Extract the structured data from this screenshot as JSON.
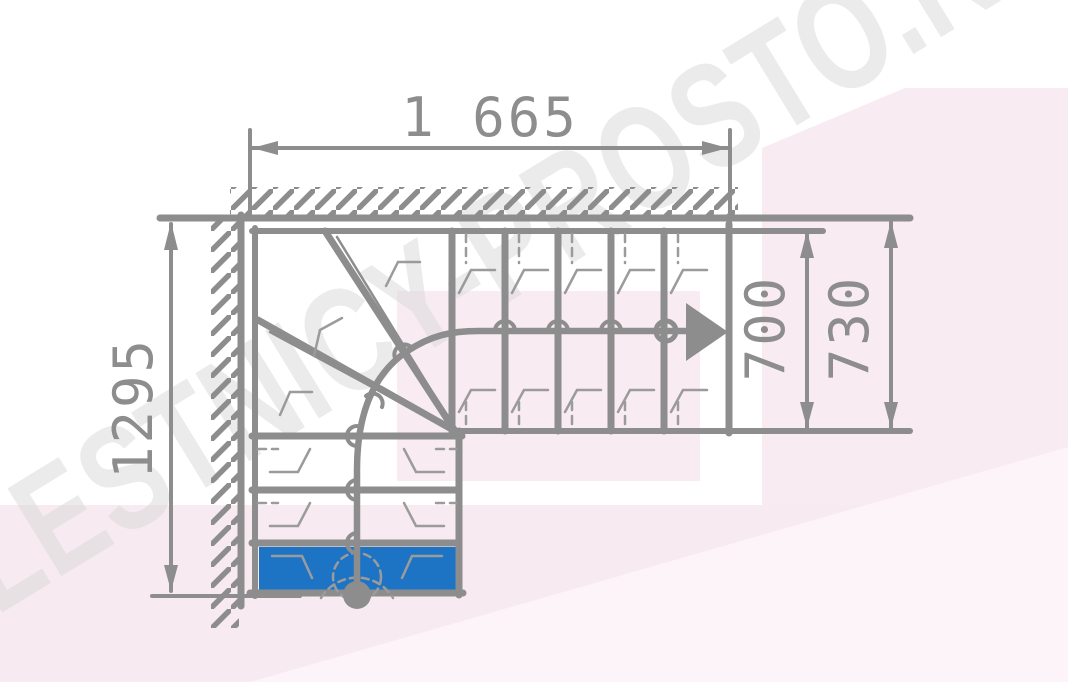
{
  "drawing": {
    "watermark": "LESTNICY-PROSTO.RU",
    "dimensions": {
      "top_width_label": "1 665",
      "left_height_label": "1295",
      "flight_width_inner_label": "700",
      "flight_width_outer_label": "730"
    },
    "colors": {
      "line_gray": "#8d8d8d",
      "thin_gray": "#9b9b9b",
      "step_blue": "#1d74c4",
      "bg_pink": "#f8ebf2",
      "bg_pink_light": "#fcf4f8",
      "watermark_gray": "#d9d9d9"
    }
  }
}
